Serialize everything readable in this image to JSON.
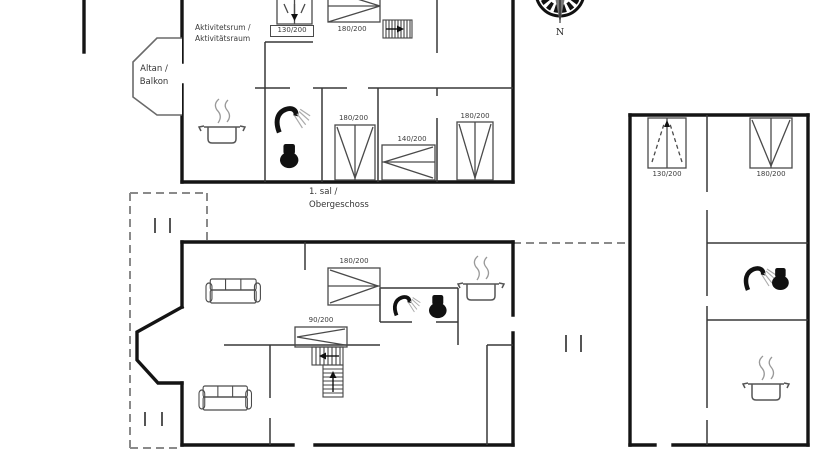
{
  "upper_floor": {
    "floor_label": {
      "line1": "1. sal /",
      "line2": "Obergeschoss"
    },
    "room_label": {
      "line1": "Aktivitetsrum /",
      "line2": "Aktivitätsraum"
    },
    "balcony_label": {
      "line1": "Altan /",
      "line2": "Balkon"
    },
    "beds": {
      "bed1": "130/200",
      "bed2": "180/200",
      "bed3": "180/200",
      "bed4": "140/200",
      "bed5": "180/200"
    }
  },
  "ground_floor": {
    "beds": {
      "double": "180/200",
      "single": "90/200"
    }
  },
  "annex": {
    "beds": {
      "bed1": "130/200",
      "bed2": "180/200"
    }
  },
  "compass": {
    "north": "N"
  }
}
